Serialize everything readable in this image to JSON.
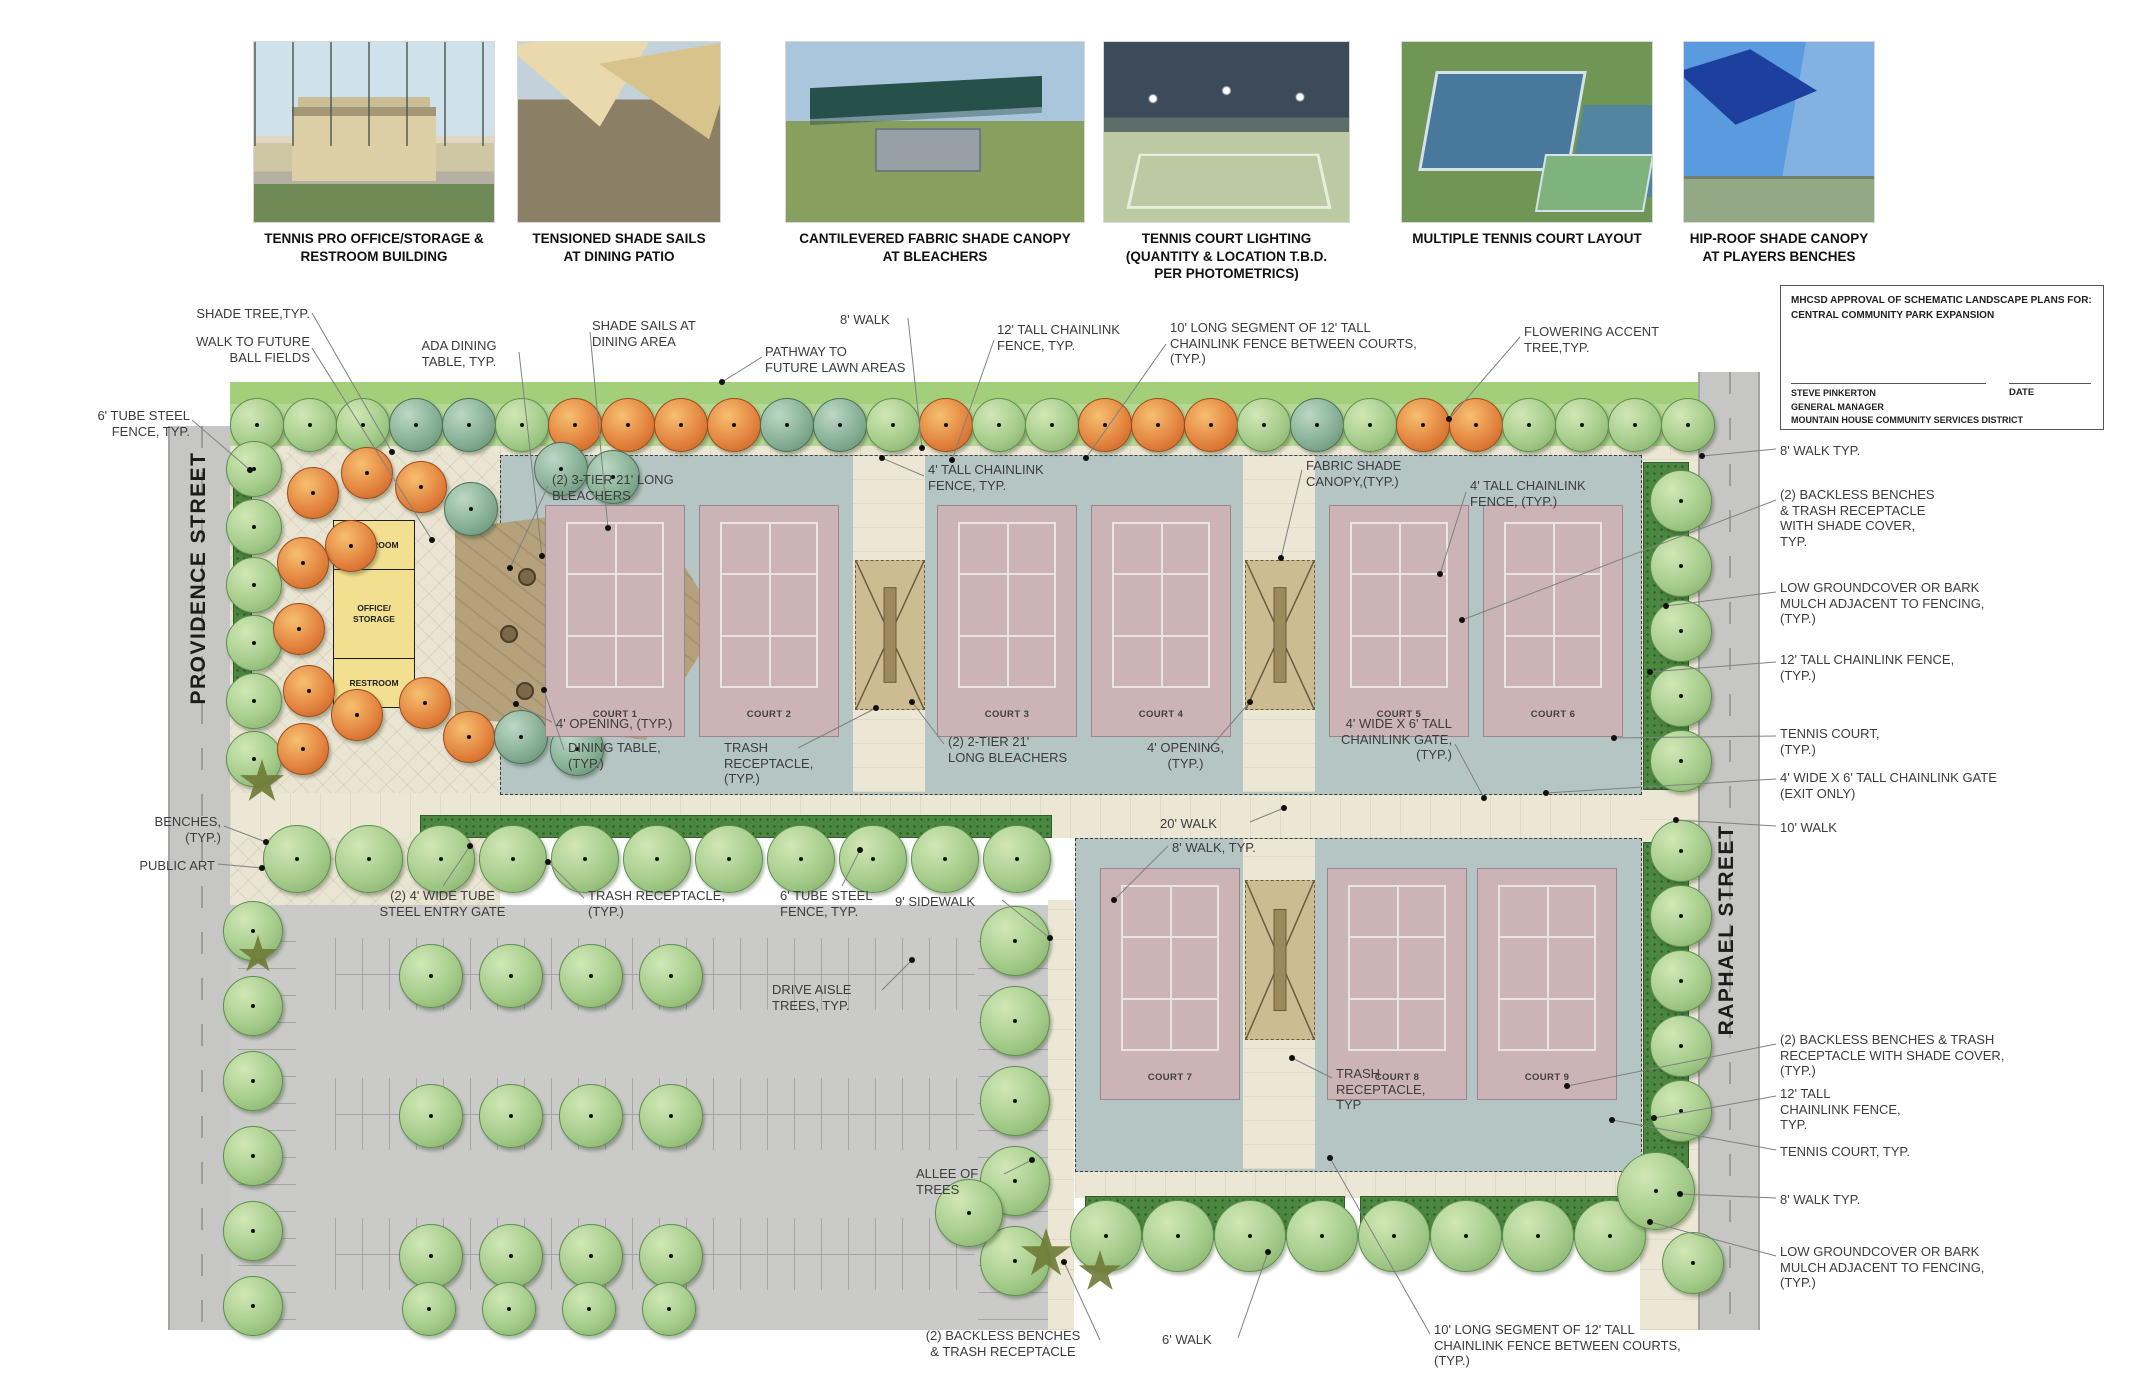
{
  "photos": [
    {
      "caption": "TENNIS PRO OFFICE/STORAGE &\nRESTROOM BUILDING"
    },
    {
      "caption": "TENSIONED SHADE SAILS\nAT DINING PATIO"
    },
    {
      "caption": "CANTILEVERED FABRIC SHADE CANOPY\nAT BLEACHERS"
    },
    {
      "caption": "TENNIS COURT LIGHTING\n(QUANTITY & LOCATION T.B.D.\nPER PHOTOMETRICS)"
    },
    {
      "caption": "MULTIPLE TENNIS COURT LAYOUT"
    },
    {
      "caption": "HIP-ROOF SHADE CANOPY\nAT PLAYERS BENCHES"
    }
  ],
  "title_block": {
    "line1": "MHCSD APPROVAL OF SCHEMATIC LANDSCAPE PLANS FOR:",
    "line2": "CENTRAL COMMUNITY PARK EXPANSION",
    "signer_name": "STEVE PINKERTON",
    "signer_title": "GENERAL MANAGER",
    "signer_org": "MOUNTAIN HOUSE COMMUNITY SERVICES DISTRICT",
    "date_label": "DATE"
  },
  "streets": {
    "left": "PROVIDENCE STREET",
    "right": "RAPHAEL STREET"
  },
  "building": {
    "top": "RESTROOM",
    "middle": "OFFICE/\nSTORAGE",
    "bottom": "RESTROOM"
  },
  "courts": [
    {
      "label": "COURT 1",
      "x": 545,
      "y": 505
    },
    {
      "label": "COURT 2",
      "x": 699,
      "y": 505
    },
    {
      "label": "COURT 3",
      "x": 937,
      "y": 505
    },
    {
      "label": "COURT 4",
      "x": 1091,
      "y": 505
    },
    {
      "label": "COURT 5",
      "x": 1329,
      "y": 505
    },
    {
      "label": "COURT 6",
      "x": 1483,
      "y": 505
    },
    {
      "label": "COURT 7",
      "x": 1100,
      "y": 868
    },
    {
      "label": "COURT 8",
      "x": 1327,
      "y": 868
    },
    {
      "label": "COURT 9",
      "x": 1477,
      "y": 868
    }
  ],
  "callouts": [
    {
      "text": "SHADE TREE,TYP.",
      "x": 140,
      "y": 306,
      "w": 170,
      "align": "right",
      "line": [
        312,
        313,
        392,
        452
      ]
    },
    {
      "text": "WALK TO FUTURE\nBALL FIELDS",
      "x": 140,
      "y": 334,
      "w": 170,
      "align": "right",
      "line": [
        312,
        348,
        432,
        540
      ]
    },
    {
      "text": "ADA DINING\nTABLE, TYP.",
      "x": 400,
      "y": 338,
      "w": 118,
      "align": "center",
      "line": [
        519,
        352,
        542,
        556
      ]
    },
    {
      "text": "SHADE SAILS AT\nDINING AREA",
      "x": 592,
      "y": 318,
      "w": 135,
      "align": "left",
      "line": [
        590,
        332,
        608,
        528
      ]
    },
    {
      "text": "PATHWAY TO\nFUTURE LAWN AREAS",
      "x": 765,
      "y": 344,
      "w": 190,
      "align": "left",
      "line": [
        762,
        357,
        722,
        382
      ]
    },
    {
      "text": "8' WALK",
      "x": 840,
      "y": 312,
      "w": 70,
      "align": "left",
      "line": [
        908,
        318,
        922,
        448
      ]
    },
    {
      "text": "12' TALL CHAINLINK\nFENCE, TYP.",
      "x": 997,
      "y": 322,
      "w": 165,
      "align": "left",
      "line": [
        994,
        340,
        952,
        460
      ]
    },
    {
      "text": "10' LONG SEGMENT OF 12' TALL\nCHAINLINK FENCE  BETWEEN COURTS,\n(TYP.)",
      "x": 1170,
      "y": 320,
      "w": 270,
      "align": "left",
      "line": [
        1166,
        344,
        1086,
        458
      ]
    },
    {
      "text": "FLOWERING ACCENT\nTREE,TYP.",
      "x": 1524,
      "y": 324,
      "w": 175,
      "align": "left",
      "line": [
        1520,
        337,
        1449,
        419
      ]
    },
    {
      "text": "6' TUBE STEEL\nFENCE, TYP.",
      "x": 58,
      "y": 408,
      "w": 132,
      "align": "right",
      "line": [
        192,
        420,
        250,
        470
      ]
    },
    {
      "text": "8' WALK TYP.",
      "x": 1780,
      "y": 443,
      "w": 150,
      "align": "left",
      "line": [
        1776,
        449,
        1702,
        456
      ]
    },
    {
      "text": "(2) BACKLESS BENCHES\n& TRASH RECEPTACLE\nWITH SHADE COVER,\nTYP.",
      "x": 1780,
      "y": 487,
      "w": 210,
      "align": "left",
      "line": [
        1776,
        500,
        1462,
        620
      ]
    },
    {
      "text": "LOW GROUNDCOVER OR BARK\nMULCH ADJACENT TO FENCING,\n(TYP.)",
      "x": 1780,
      "y": 580,
      "w": 240,
      "align": "left",
      "line": [
        1776,
        592,
        1666,
        606
      ]
    },
    {
      "text": "12' TALL CHAINLINK FENCE,\n(TYP.)",
      "x": 1780,
      "y": 652,
      "w": 230,
      "align": "left",
      "line": [
        1776,
        662,
        1650,
        672
      ]
    },
    {
      "text": "TENNIS COURT,\n(TYP.)",
      "x": 1780,
      "y": 726,
      "w": 160,
      "align": "left",
      "line": [
        1776,
        736,
        1614,
        738
      ]
    },
    {
      "text": "4' WIDE X 6' TALL CHAINLINK GATE\n(EXIT ONLY)",
      "x": 1780,
      "y": 770,
      "w": 300,
      "align": "left",
      "line": [
        1776,
        779,
        1546,
        793
      ]
    },
    {
      "text": "10' WALK",
      "x": 1780,
      "y": 820,
      "w": 100,
      "align": "left",
      "line": [
        1776,
        826,
        1676,
        820
      ]
    },
    {
      "text": "(2) BACKLESS BENCHES & TRASH\nRECEPTACLE WITH SHADE COVER,\n(TYP.)",
      "x": 1780,
      "y": 1032,
      "w": 260,
      "align": "left",
      "line": [
        1776,
        1044,
        1567,
        1086
      ]
    },
    {
      "text": "12' TALL\nCHAINLINK FENCE,\nTYP.",
      "x": 1780,
      "y": 1086,
      "w": 170,
      "align": "left",
      "line": [
        1776,
        1096,
        1654,
        1118
      ]
    },
    {
      "text": "TENNIS COURT, TYP.",
      "x": 1780,
      "y": 1144,
      "w": 190,
      "align": "left",
      "line": [
        1776,
        1150,
        1612,
        1120
      ]
    },
    {
      "text": "8' WALK TYP.",
      "x": 1780,
      "y": 1192,
      "w": 140,
      "align": "left",
      "line": [
        1776,
        1198,
        1680,
        1194
      ]
    },
    {
      "text": "LOW GROUNDCOVER OR BARK\nMULCH ADJACENT TO FENCING,\n(TYP.)",
      "x": 1780,
      "y": 1244,
      "w": 240,
      "align": "left",
      "line": [
        1776,
        1256,
        1650,
        1222
      ]
    },
    {
      "text": "(2) 3-TIER 21' LONG\nBLEACHERS",
      "x": 552,
      "y": 472,
      "w": 165,
      "align": "left",
      "line": [
        548,
        486,
        510,
        568
      ]
    },
    {
      "text": "4' TALL CHAINLINK\nFENCE, TYP.",
      "x": 928,
      "y": 462,
      "w": 155,
      "align": "left",
      "line": [
        924,
        476,
        882,
        458
      ]
    },
    {
      "text": "FABRIC SHADE\nCANOPY,(TYP.)",
      "x": 1306,
      "y": 458,
      "w": 135,
      "align": "left",
      "line": [
        1302,
        470,
        1281,
        558
      ]
    },
    {
      "text": "4' TALL CHAINLINK\nFENCE, (TYP.)",
      "x": 1470,
      "y": 478,
      "w": 155,
      "align": "left",
      "line": [
        1466,
        492,
        1440,
        574
      ]
    },
    {
      "text": "4' OPENING, (TYP.)",
      "x": 556,
      "y": 716,
      "w": 150,
      "align": "left",
      "line": [
        552,
        722,
        516,
        704
      ]
    },
    {
      "text": "DINING TABLE,\n(TYP.)",
      "x": 568,
      "y": 740,
      "w": 135,
      "align": "left",
      "line": [
        564,
        750,
        544,
        690
      ]
    },
    {
      "text": "TRASH\nRECEPTACLE,\n(TYP.)",
      "x": 724,
      "y": 740,
      "w": 125,
      "align": "left",
      "line": [
        798,
        748,
        876,
        708
      ]
    },
    {
      "text": "(2) 2-TIER 21'\nLONG BLEACHERS",
      "x": 948,
      "y": 734,
      "w": 150,
      "align": "left",
      "line": [
        944,
        744,
        912,
        702
      ]
    },
    {
      "text": "4' OPENING,\n(TYP.)",
      "x": 1128,
      "y": 740,
      "w": 115,
      "align": "center",
      "line": [
        1208,
        750,
        1250,
        702
      ]
    },
    {
      "text": "4' WIDE X 6' TALL\nCHAINLINK GATE,\n(TYP.)",
      "x": 1290,
      "y": 716,
      "w": 162,
      "align": "right",
      "line": [
        1455,
        744,
        1484,
        798
      ]
    },
    {
      "text": "20' WALK",
      "x": 1160,
      "y": 816,
      "w": 92,
      "align": "left",
      "line": [
        1250,
        822,
        1284,
        808
      ]
    },
    {
      "text": "8' WALK, TYP.",
      "x": 1172,
      "y": 840,
      "w": 125,
      "align": "left",
      "line": [
        1168,
        846,
        1114,
        900
      ]
    },
    {
      "text": "BENCHES,\n(TYP.)",
      "x": 116,
      "y": 814,
      "w": 105,
      "align": "right",
      "line": [
        224,
        826,
        266,
        842
      ]
    },
    {
      "text": "PUBLIC ART",
      "x": 110,
      "y": 858,
      "w": 105,
      "align": "right",
      "line": [
        218,
        864,
        262,
        868
      ]
    },
    {
      "text": "(2) 4' WIDE TUBE\nSTEEL ENTRY GATE",
      "x": 360,
      "y": 888,
      "w": 165,
      "align": "center",
      "line": [
        443,
        886,
        470,
        846
      ]
    },
    {
      "text": "TRASH RECEPTACLE,\n(TYP.)",
      "x": 588,
      "y": 888,
      "w": 175,
      "align": "left",
      "line": [
        584,
        898,
        548,
        862
      ]
    },
    {
      "text": "6' TUBE STEEL\nFENCE, TYP.",
      "x": 780,
      "y": 888,
      "w": 135,
      "align": "left",
      "line": [
        842,
        886,
        860,
        850
      ]
    },
    {
      "text": "9' SIDEWALK",
      "x": 895,
      "y": 894,
      "w": 110,
      "align": "left",
      "line": [
        1002,
        900,
        1050,
        938
      ]
    },
    {
      "text": "DRIVE AISLE\nTREES, TYP.",
      "x": 772,
      "y": 982,
      "w": 132,
      "align": "left",
      "line": [
        882,
        990,
        912,
        960
      ]
    },
    {
      "text": "ALLEE OF\nTREES",
      "x": 916,
      "y": 1166,
      "w": 92,
      "align": "left",
      "line": [
        1004,
        1174,
        1032,
        1160
      ]
    },
    {
      "text": "TRASH\nRECEPTACLE,\nTYP",
      "x": 1336,
      "y": 1066,
      "w": 125,
      "align": "left",
      "line": [
        1332,
        1078,
        1292,
        1058
      ]
    },
    {
      "text": "(2) BACKLESS BENCHES\n& TRASH RECEPTACLE",
      "x": 908,
      "y": 1328,
      "w": 190,
      "align": "center",
      "line": [
        1100,
        1340,
        1064,
        1262
      ]
    },
    {
      "text": "6' WALK",
      "x": 1162,
      "y": 1332,
      "w": 80,
      "align": "left",
      "line": [
        1238,
        1338,
        1268,
        1252
      ]
    },
    {
      "text": "10' LONG SEGMENT OF 12' TALL\nCHAINLINK FENCE  BETWEEN COURTS,\n(TYP.)",
      "x": 1434,
      "y": 1322,
      "w": 290,
      "align": "left",
      "line": [
        1430,
        1334,
        1330,
        1158
      ]
    }
  ],
  "colors": {
    "court_surface": "#cbb3b6",
    "court_apron": "#b5c5c4",
    "lawn": "#b6d795",
    "hedge": "#4c8741",
    "walk": "#ece7d4",
    "building": "#f2df90",
    "canopy": "#cdbb92"
  }
}
